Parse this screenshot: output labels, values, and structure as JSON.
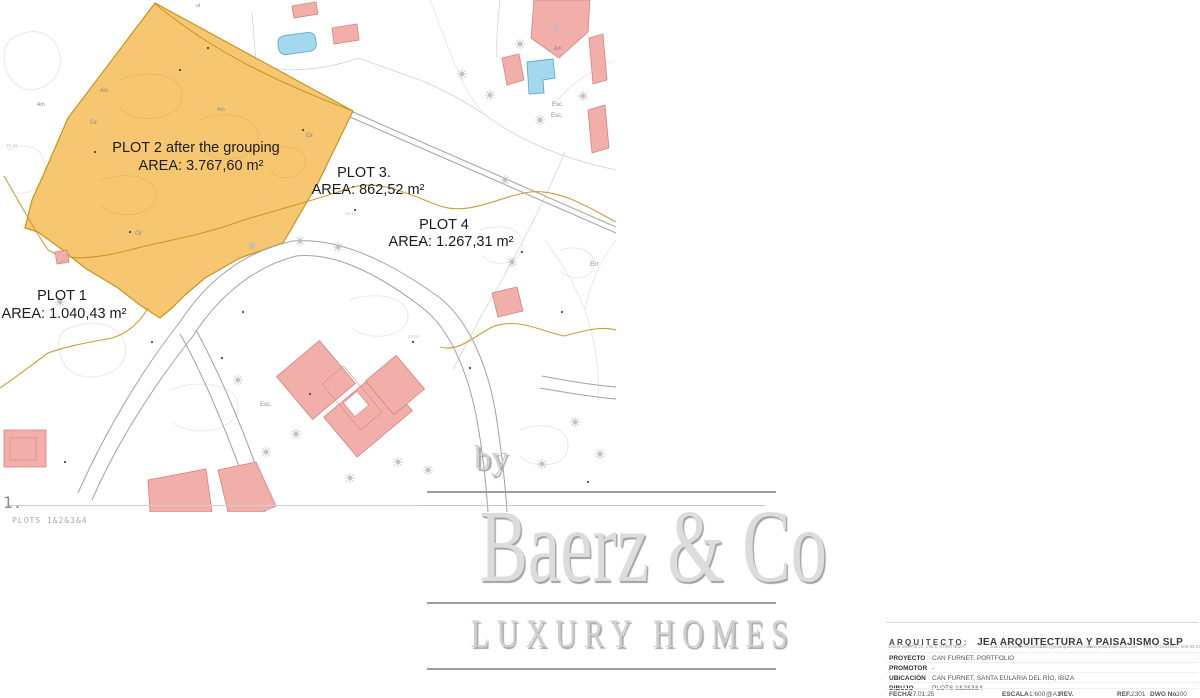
{
  "map": {
    "plots": {
      "plot1": {
        "name": "PLOT 1",
        "area": "AREA: 1.040,43 m²"
      },
      "plot2": {
        "name": "PLOT 2 after the grouping",
        "area": "AREA: 3.767,60 m²"
      },
      "plot3": {
        "name": "PLOT 3.",
        "area": "AREA: 862,52 m²"
      },
      "plot4": {
        "name": "PLOT 4",
        "area": "AREA: 1.267,31 m²"
      }
    },
    "labels": {
      "ut": "ut",
      "esc1": "Esc.",
      "esc2": "Esc.",
      "esc3": "Esc.",
      "err": "Err",
      "gr1": "Gr",
      "gr2": "Gr",
      "gr3": "Gr",
      "arb1": "Arb",
      "arb2": "Arb",
      "arb3": "Arb",
      "arb4": "Arb",
      "pt1": "25.44",
      "pt2": "20.56",
      "pt3": "24.65",
      "pt4": "22.13"
    },
    "colors": {
      "plot_fill": "#F5C365",
      "plot_stroke": "#C8921E",
      "building_fill": "#F2AEA9",
      "building_stroke": "#D4837E",
      "pool_fill": "#A5D8EC",
      "pool_stroke": "#55AFD4",
      "road": "#A2A2A2",
      "stream": "#C8921E"
    }
  },
  "drawing_label": {
    "number": "1.",
    "plots": "PLOTS 1&2&3&4"
  },
  "logo": {
    "by": "by",
    "name": "Baerz & Co",
    "tagline": "LUXURY HOMES"
  },
  "title_block": {
    "architect_label": "ARQUITECTO:",
    "architect_name": "JEA ARQUITECTURA Y PAISAJISMO SLP",
    "contact": {
      "address": "Carrer des Pla 28, Vila 6, 07800 IBIZA",
      "person": "Juan Echevarría Arquitecto",
      "email": "mail@jeaarquitectura.com",
      "web": "www.jeaarquitectura.com",
      "phone": "Tfno. 971634584 / 600 50 2740"
    },
    "rows": [
      {
        "label": "PROYECTO",
        "value": "CAN FURNET, PORTFOLIO"
      },
      {
        "label": "PROMOTOR",
        "value": "-"
      },
      {
        "label": "UBICACIÓN",
        "value": "CAN FURNET, SANTA EULARIA DEL RÍO, IBIZA"
      },
      {
        "label": "DIBUJO",
        "value": "PLOTS 1&2&3&4"
      }
    ],
    "fecha_label": "FECHA",
    "fecha_value": "27.01.25",
    "escala_label": "ESCALA",
    "escala_value": "1:600",
    "formato": "@A1",
    "rev_label": "REV.",
    "ref_label": "REF.",
    "ref_value": "2301",
    "dwg_label": "DWG No.",
    "dwg_value": "300"
  }
}
